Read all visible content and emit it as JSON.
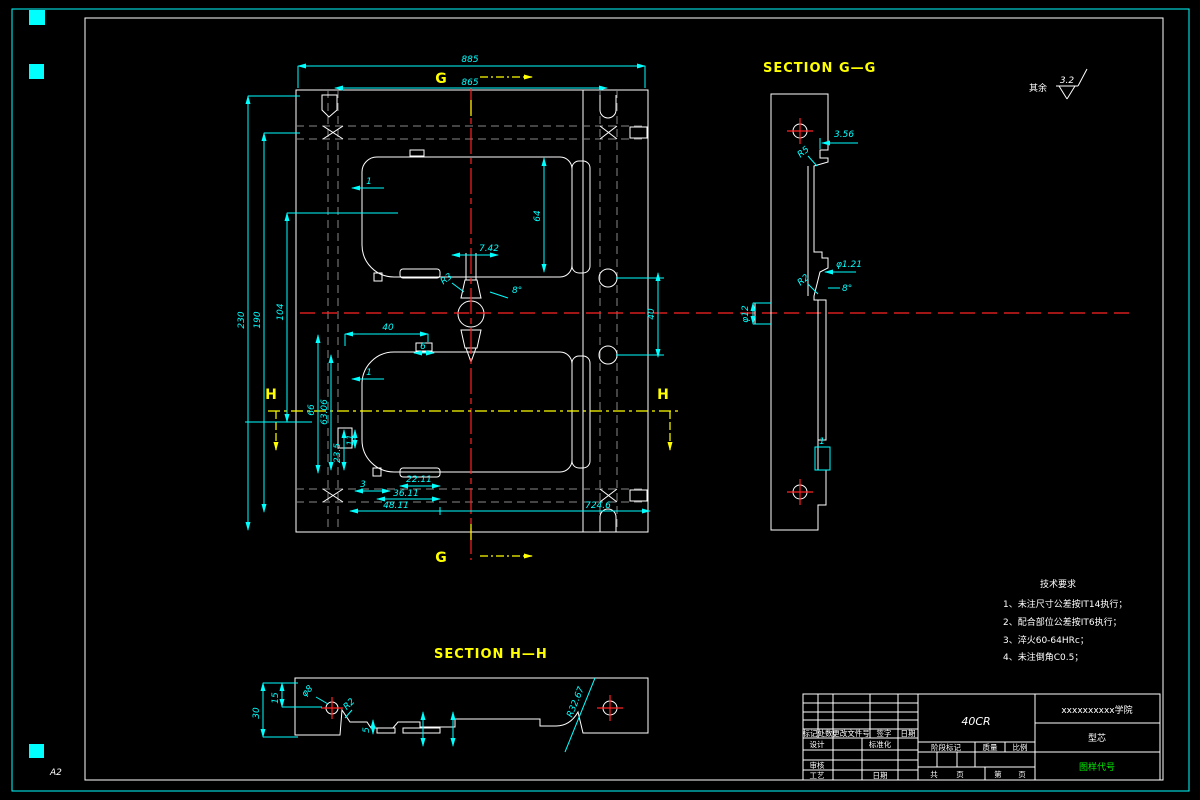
{
  "sheet": {
    "format_label": "A2"
  },
  "finish_note": {
    "prefix": "其余",
    "roughness": "3.2"
  },
  "section_labels": {
    "gg": "SECTION G—G",
    "hh": "SECTION H—H",
    "g_top": "G",
    "g_bottom": "G",
    "h_left": "H",
    "h_right": "H"
  },
  "main_dims": {
    "overall_width": "885",
    "inner_width": "865",
    "overall_height": "230",
    "mid_height": "190",
    "inner_height": "104",
    "cavity_height": "64",
    "gate_width": "7.42",
    "gate_radius": "R3",
    "gate_angle": "8°",
    "offset_40": "40",
    "tab_6": "6",
    "corner_1_top": "1",
    "corner_1_bottom": "1",
    "v_66": "66",
    "v_63_06": "63.06",
    "v_23_5": "23.5",
    "v_11": "11",
    "d_3": "3",
    "d_22_11": "22.11",
    "d_36_11": "36.11",
    "d_48_11": "48.11",
    "cavity_width": "724.6",
    "hole_pitch": "40"
  },
  "gg_dims": {
    "step_3_56": "3.56",
    "r5": "R5",
    "dia_1_21": "φ1.21",
    "angle_8": "8°",
    "r2": "R2",
    "dia_12": "φ12",
    "detail_1": "1"
  },
  "hh_dims": {
    "t_30": "30",
    "t_15": "15",
    "dia_8": "φ8",
    "r2": "R2",
    "d_5": "5",
    "r_32_67": "R32.67"
  },
  "tech_req": {
    "title": "技术要求",
    "items": [
      "1、未注尺寸公差按IT14执行；",
      "2、配合部位公差按IT6执行；",
      "3、淬火60-64HRc；",
      "4、未注倒角C0.5；"
    ]
  },
  "title_block": {
    "material": "40CR",
    "company": "xxxxxxxxxx学院",
    "part_name": "型芯",
    "drawing_code": "图样代号",
    "rev_headers": [
      "标记",
      "处数",
      "更改文件号",
      "签字",
      "日期"
    ],
    "design": "设计",
    "standardization": "标准化",
    "review": "审核",
    "process": "工艺",
    "date": "日期",
    "stage_mark": "阶段标记",
    "weight": "质量",
    "scale": "比例",
    "total_label": "共",
    "page_label": "页",
    "sheet_label": "第",
    "page_label2": "页"
  }
}
